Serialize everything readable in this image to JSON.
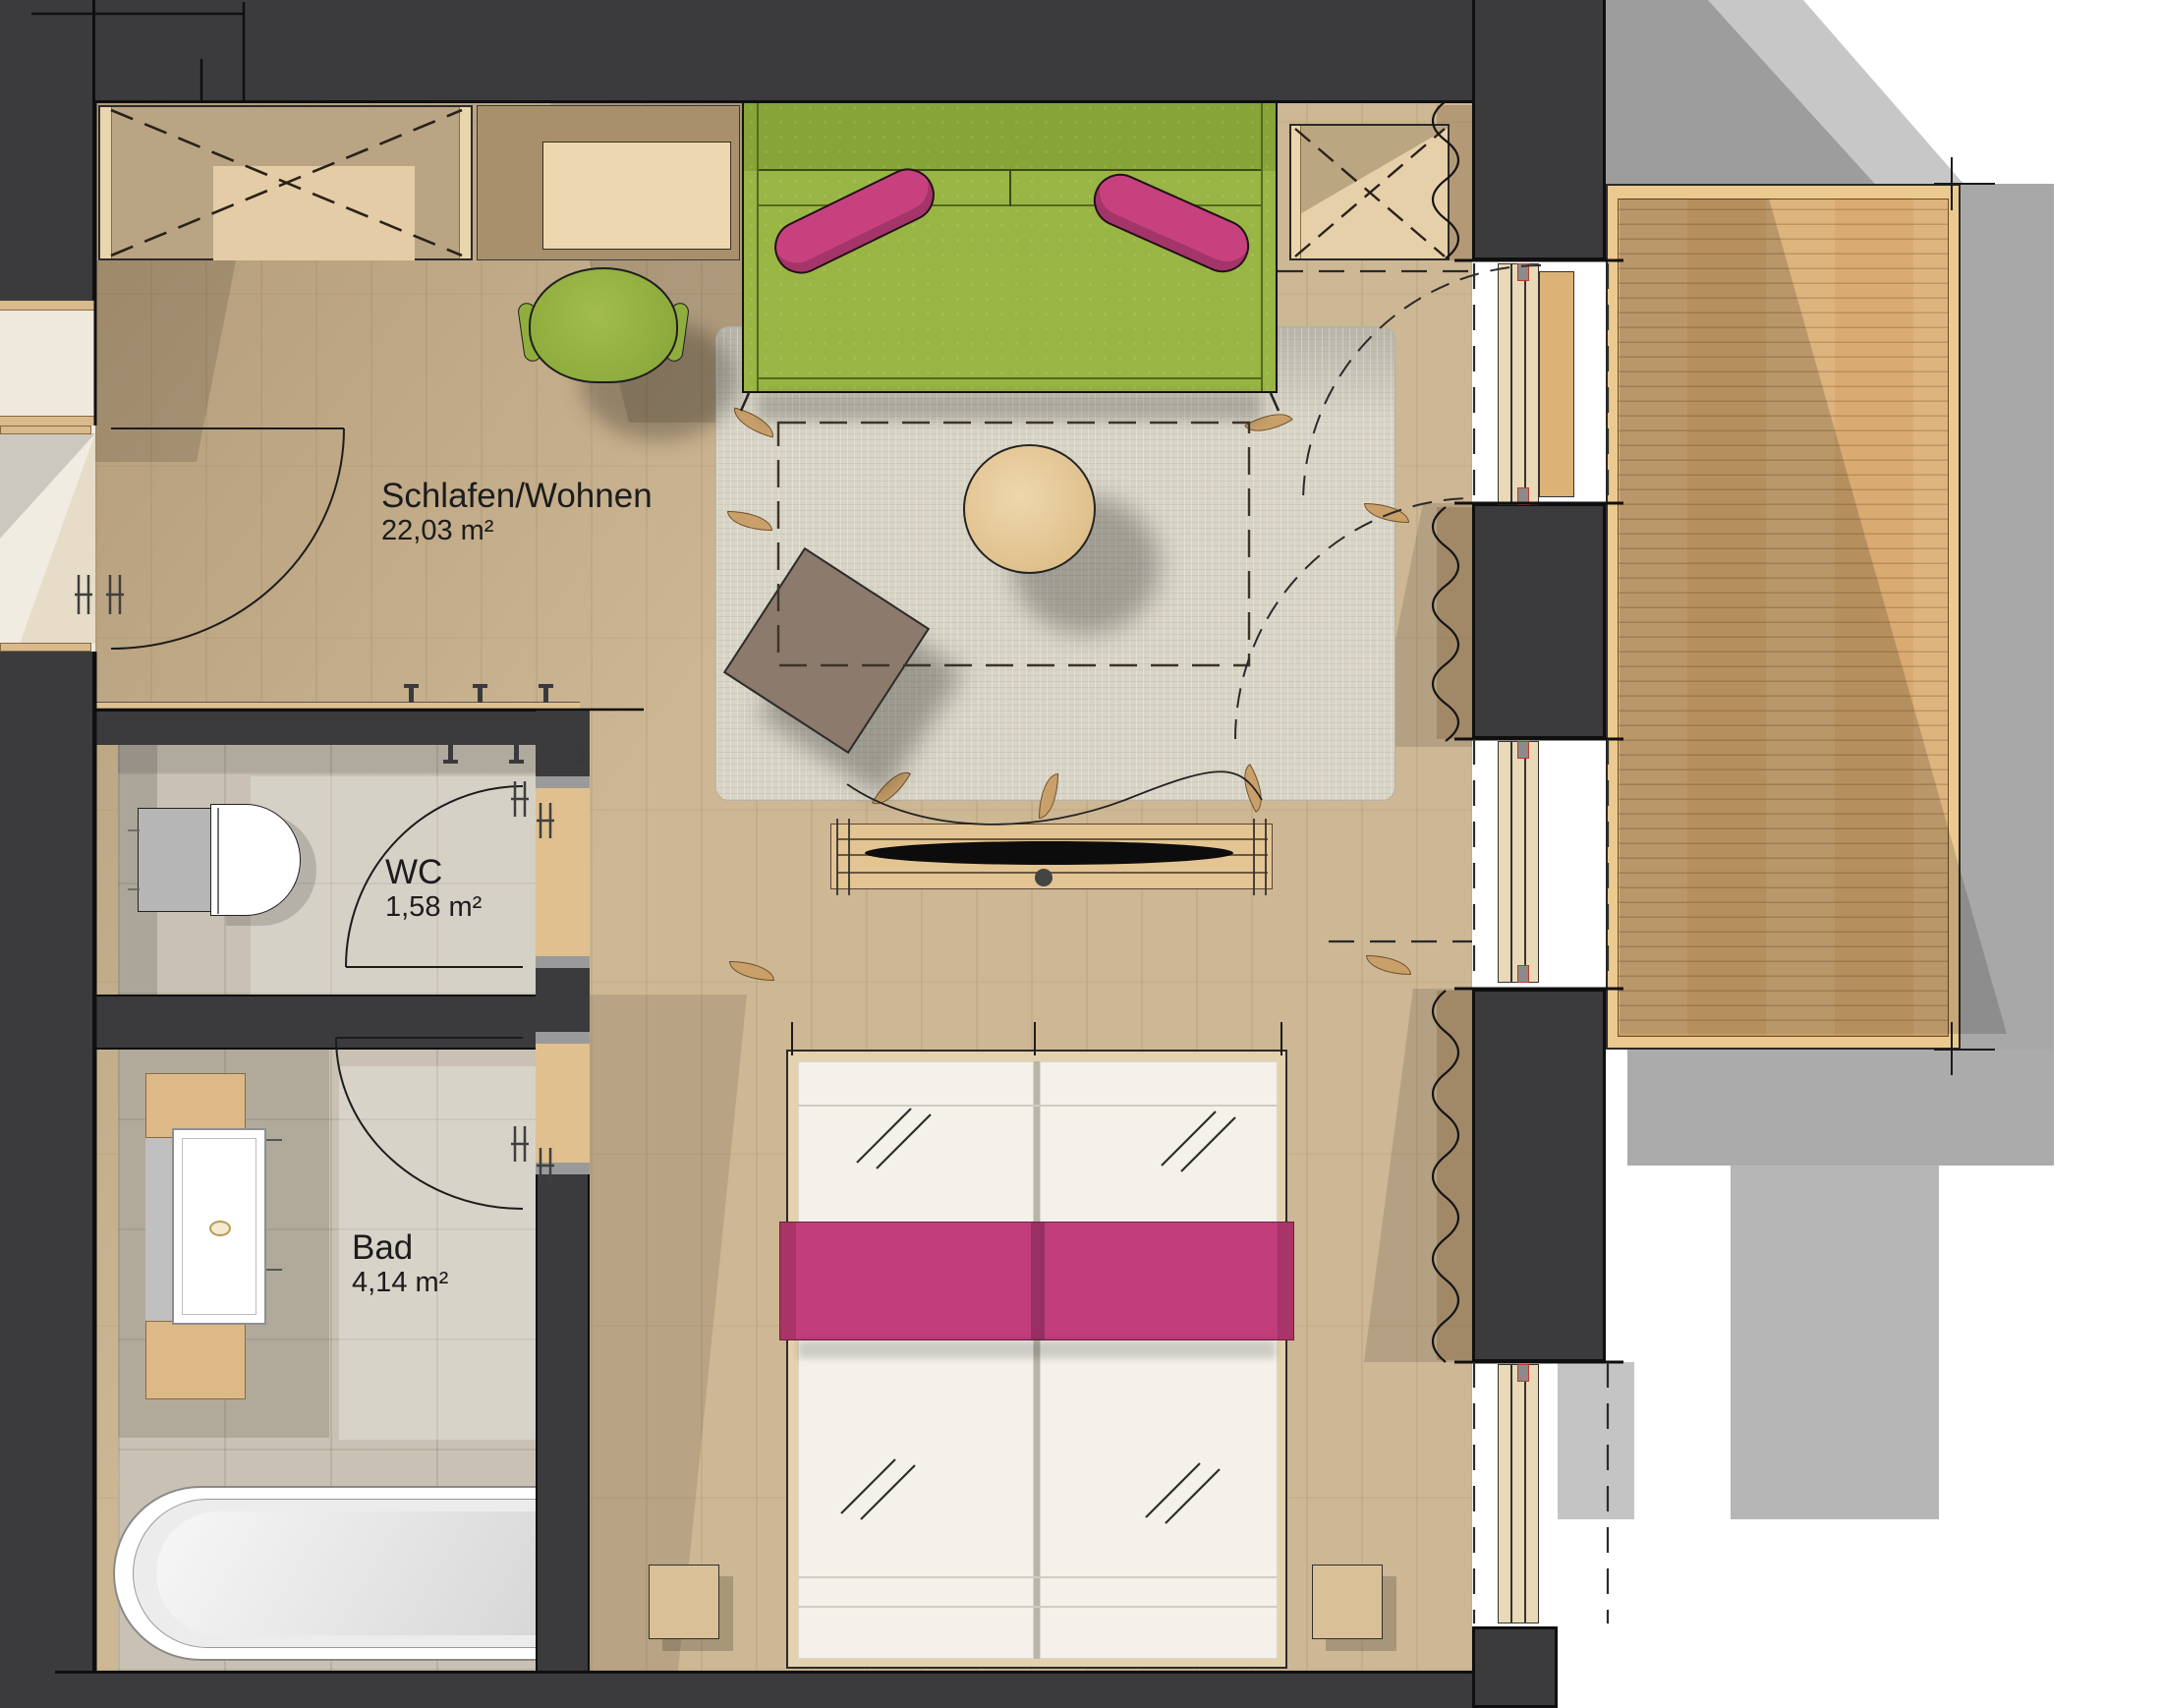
{
  "plan": {
    "type": "apartment-floor-plan",
    "rooms": [
      {
        "id": "schlafen_wohnen",
        "name": "Schlafen/Wohnen",
        "area": "22,03 m²"
      },
      {
        "id": "wc",
        "name": "WC",
        "area": "1,58 m²"
      },
      {
        "id": "bad",
        "name": "Bad",
        "area": "4,14 m²"
      }
    ],
    "colors": {
      "wall": "#3b3b3d",
      "room_floor": "#cdb794",
      "balcony_deck": "#d9ab72",
      "tile": "#c9c2b4",
      "rug": "#d8d4c6",
      "sofa_green": "#94b03f",
      "accent_pink": "#c23d7c",
      "bed_white": "#f4f1ea",
      "shadow_gray": "#a8a8a8"
    }
  }
}
